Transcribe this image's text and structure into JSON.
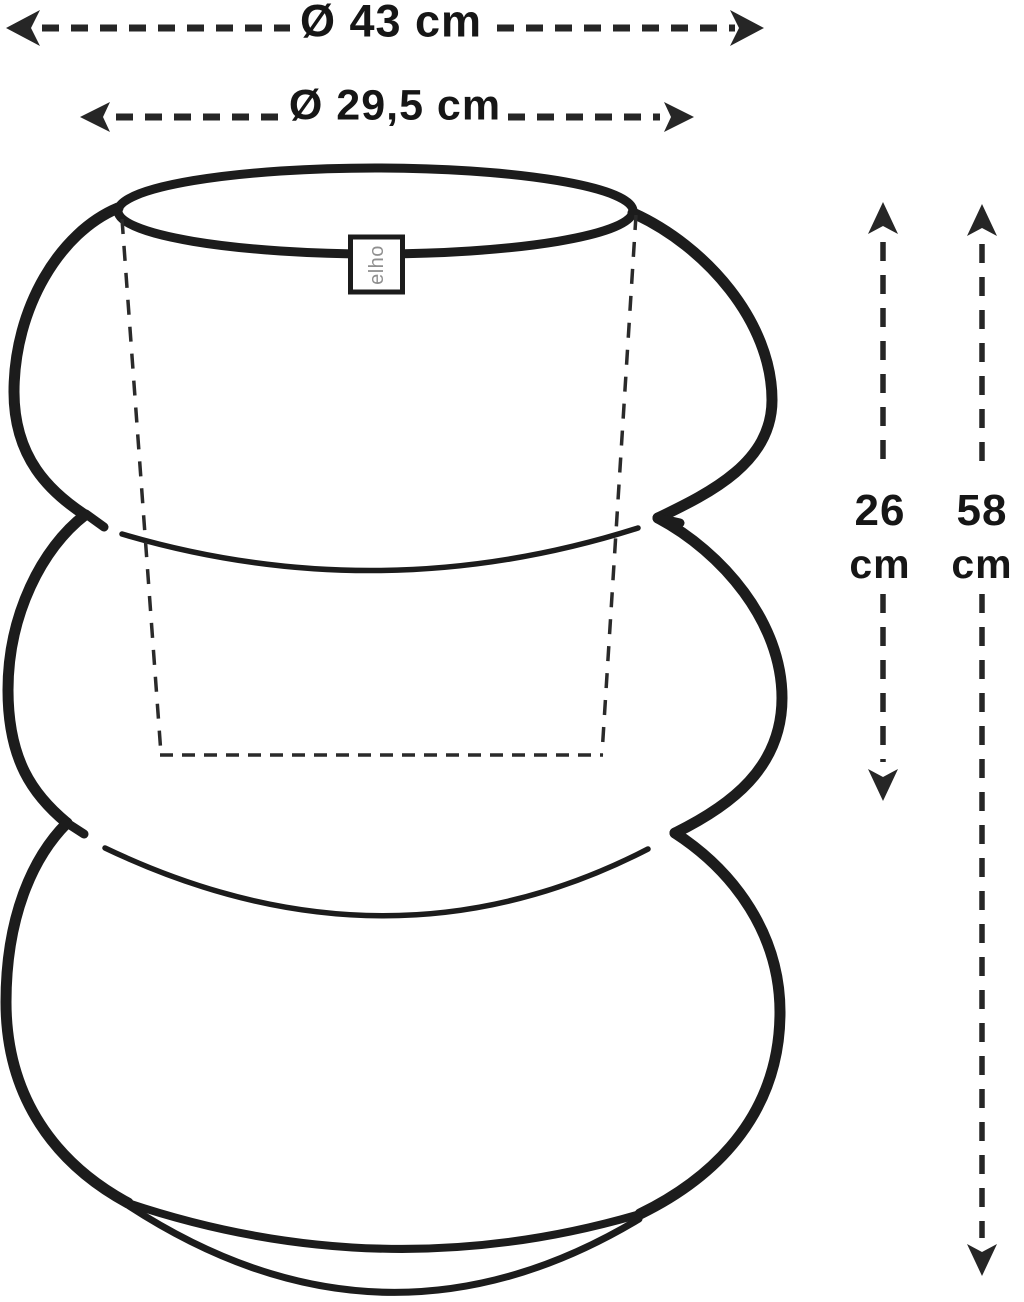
{
  "figure": {
    "kind": "product dimension diagram",
    "subject": "three-tier bubble flower pot with saucer",
    "brand_label": "elho"
  },
  "dimensions": {
    "outer_diameter": {
      "label": "Ø 43 cm"
    },
    "inner_diameter": {
      "label": "Ø 29,5 cm"
    },
    "inner_height": {
      "value": "26",
      "unit": "cm"
    },
    "total_height": {
      "value": "58",
      "unit": "cm"
    }
  },
  "colors": {
    "line": "#1c1c1c",
    "arrow": "#262626",
    "text": "#161616",
    "brand_text": "#8f8f8f",
    "background": "#ffffff"
  }
}
